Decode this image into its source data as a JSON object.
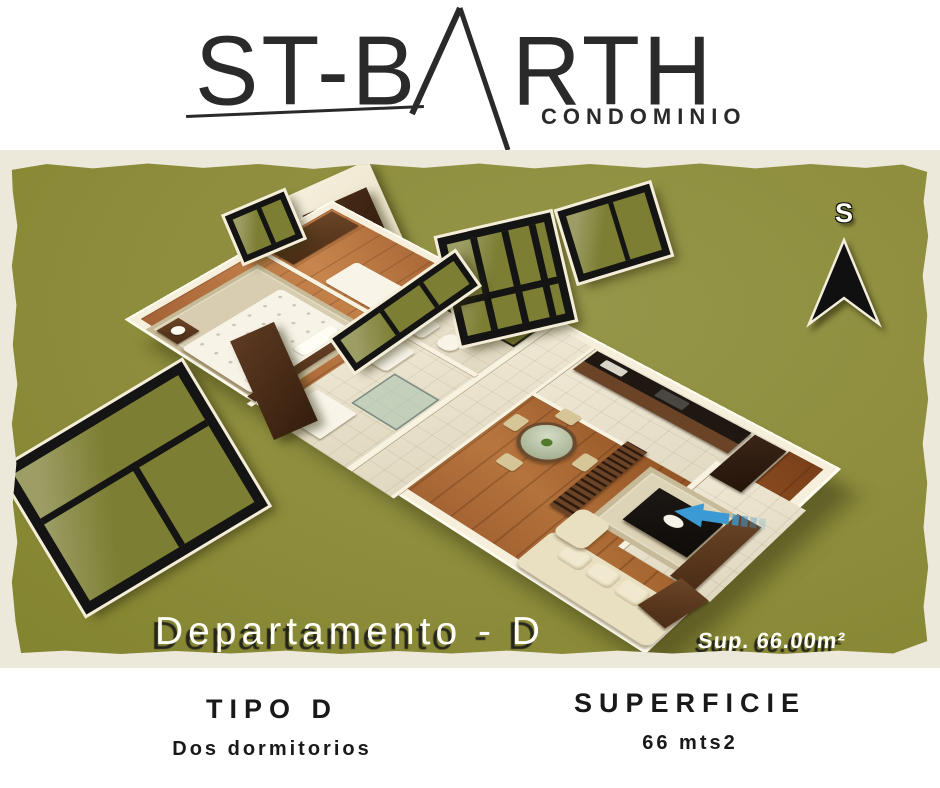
{
  "brand": {
    "part1": "ST-B",
    "part2": "RTH",
    "full_name": "ST-BARTH",
    "subtitle": "CONDOMINIO"
  },
  "board": {
    "caption": "Departamento - D",
    "surface_note": "Sup. 66.00m²",
    "compass_label": "S"
  },
  "specs": {
    "type_title": "TIPO D",
    "type_subtitle": "Dos dormitorios",
    "surface_title": "SUPERFICIE",
    "surface_value": "66 mts2"
  },
  "palette": {
    "board_green": "#8d8d3c",
    "frame_cream": "#ece9db",
    "wall_cream": "#f6efdc",
    "wood_floor": "#b06a32",
    "dark_wood": "#5d3a22",
    "window_frame_black": "#141414",
    "window_glass_olive": "#7c7e33",
    "sofa_cream": "#e9e0c2",
    "arrow_blue": "#3b9ad3",
    "text_dark": "#1c1c1c"
  }
}
